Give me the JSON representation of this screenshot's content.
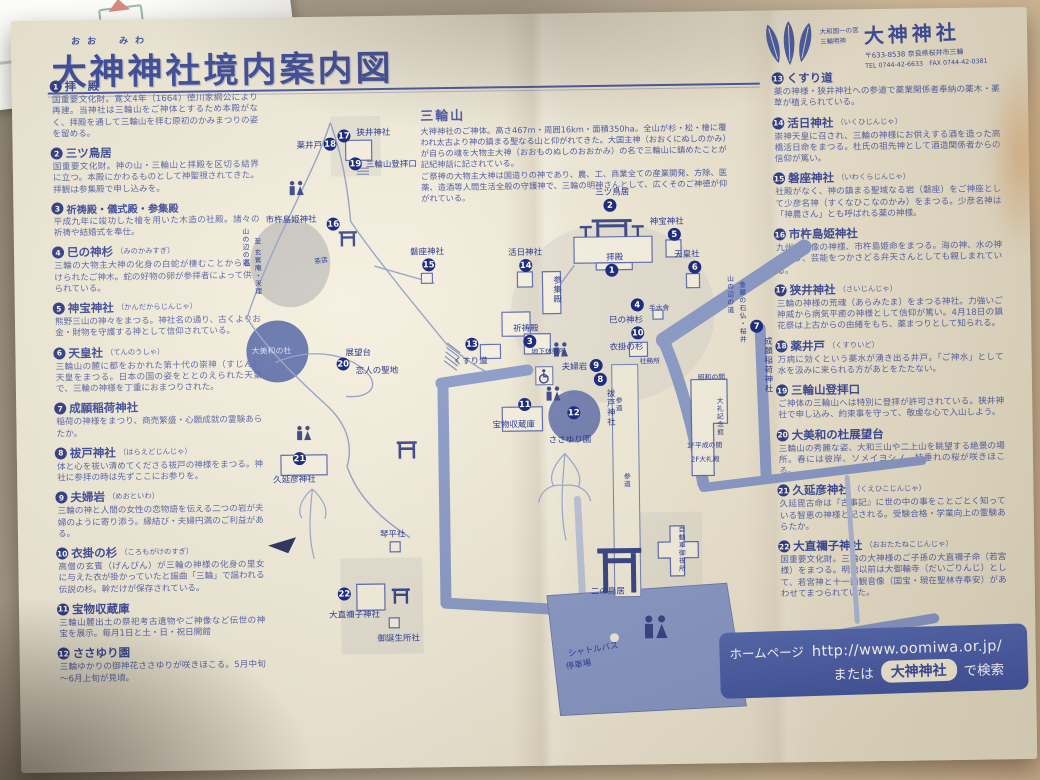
{
  "header": {
    "furigana": "おお　みわ",
    "title": "大神神社境内案内図"
  },
  "brand": {
    "line1": "大和国一の宮",
    "line2": "三輪明神",
    "name": "大神神社",
    "address": "〒633-8538 奈良県桜井市三輪",
    "tel": "TEL 0744-42-6633　FAX 0744-42-0381"
  },
  "mountain_note": {
    "title": "三輪山",
    "body": "大神神社のご神体。高さ467m・周囲16km・面積350ha。全山が杉・松・檜に覆われ太古より神の鎮まる聖なる山と仰がれてきた。大国主神（おおくにぬしのかみ）が自らの魂を大物主大神（おおものぬしのおおかみ）の名で三輪山に鎮めたことが記紀神話に記されている。\nご祭神の大物主大神は国造りの神であり、農、工、商業全ての産業開発、方除、医薬、造酒等人間生活全般の守護神で、三輪の明神さんとして、広くそのご神徳が仰がれている。"
  },
  "legend_left": [
    {
      "num": "1",
      "title": "拝　殿",
      "kana": "",
      "desc": "国重要文化財。寛文4年（1664）徳川家綱公により再建。当神社は三輪山をご神体とするため本殿がなく、拝殿を通して三輪山を拝む原初のかみまつりの姿を留める。"
    },
    {
      "num": "2",
      "title": "三ツ鳥居",
      "kana": "",
      "desc": "国重要文化財。神の山・三輪山と拝殿を区切る結界に立つ。本殿にかわるものとして神聖視されてきた。拝観は参集殿で申し込みを。"
    },
    {
      "num": "3",
      "title": "祈祷殿・儀式殿・参集殿",
      "kana": "",
      "desc": "平成九年に竣功した檜を用いた木造の社殿。諸々の祈祷や結婚式を奉仕。"
    },
    {
      "num": "4",
      "title": "巳の神杉",
      "kana": "（みのかみすぎ）",
      "desc": "三輪の大物主大神の化身の白蛇が棲むことから名付けられたご神木。蛇の好物の卵が参拝者によって供えられている。"
    },
    {
      "num": "5",
      "title": "神宝神社",
      "kana": "（かんだからじんじゃ）",
      "desc": "熊野三山の神々をまつる。神社名の通り、古くよりお金・財物を守護する神として信仰されている。"
    },
    {
      "num": "6",
      "title": "天皇社",
      "kana": "（てんのうしゃ）",
      "desc": "三輪山の麓に都をおかれた第十代の崇神（すじん）天皇をまつる。日本の国の姿をととのえられた天皇で、三輪の神様を丁重におまつりされた。"
    },
    {
      "num": "7",
      "title": "成願稲荷神社",
      "kana": "（じょうがんいなりじんじゃ）",
      "desc": "稲荷の神様をまつり、商売繁盛・心願成就の霊験あらたか。"
    },
    {
      "num": "8",
      "title": "祓戸神社",
      "kana": "（はらえどじんじゃ）",
      "desc": "体と心を祓い清めてくださる祓戸の神様をまつる。神社に参拝の時は先ずここにお参りを。"
    },
    {
      "num": "9",
      "title": "夫婦岩",
      "kana": "（めおといわ）",
      "desc": "三輪の神と人間の女性の恋物語を伝える二つの岩が夫婦のように寄り添う。縁結び・夫婦円満のご利益がある。"
    },
    {
      "num": "10",
      "title": "衣掛の杉",
      "kana": "（ころもがけのすぎ）",
      "desc": "高僧の玄賓（げんぴん）が三輪の神様の化身の里女に与えた衣が掛かっていたと謡曲「三輪」で謡われる伝説の杉。幹だけが保存されている。"
    },
    {
      "num": "11",
      "title": "宝物収蔵庫",
      "kana": "",
      "desc": "三輪山麓出土の祭祀考古遺物やご神像など伝世の神宝を展示。毎月1日と土・日・祝日開館"
    },
    {
      "num": "12",
      "title": "ささゆり園",
      "kana": "",
      "desc": "三輪ゆかりの御神花ささゆりが咲きほこる。5月中旬～6月上旬が見頃。"
    }
  ],
  "legend_right": [
    {
      "num": "13",
      "title": "くすり道",
      "kana": "",
      "desc": "薬の神様・狭井神社への参道で薬業関係者奉納の薬木・薬草が植えられている。"
    },
    {
      "num": "14",
      "title": "活日神社",
      "kana": "（いくひじんじゃ）",
      "desc": "崇神天皇に召され、三輪の神様にお供えする酒を造った高橋活日命をまつる。杜氏の祖先神として酒造関係者からの信仰が篤い。"
    },
    {
      "num": "15",
      "title": "磐座神社",
      "kana": "（いわくらじんじゃ）",
      "desc": "社殿がなく、神の鎮まる聖域なる岩（磐座）をご神座として少彦名神（すくなひこなのかみ）をまつる。少彦名神は「神農さん」とも呼ばれる薬の神様。"
    },
    {
      "num": "16",
      "title": "市杵島姫神社",
      "kana": "（いちきしまひめじんじゃ）",
      "desc": "九州の宗像の神様、市杵島姫命をまつる。海の神、水の神であり、芸能をつかさどる弁天さんとしても親しまれている。"
    },
    {
      "num": "17",
      "title": "狭井神社",
      "kana": "（さいじんじゃ）",
      "desc": "三輪の神様の荒魂（あらみたま）をまつる神社。力強いご神威から病気平癒の神様として信仰が篤い。4月18日の鎮花祭は上古からの由緒をもち、薬まつりとして知られる。"
    },
    {
      "num": "18",
      "title": "薬井戸",
      "kana": "（くすりいど）",
      "desc": "万病に効くという薬水が湧き出る井戸。「ご神水」として水を汲みに来られる方があとをたたない。"
    },
    {
      "num": "19",
      "title": "三輪山登拝口",
      "kana": "",
      "desc": "ご神体の三輪山へは特別に登拝が許可されている。狭井神社で申し込み、約束事を守って、敬虔な心で入山しよう。"
    },
    {
      "num": "20",
      "title": "大美和の杜展望台",
      "kana": "",
      "desc": "三輪山の秀麗な姿、大和三山や二上山を眺望する絶景の場所。春には彼岸、ソメイヨシノ、枝垂れの桜が咲きほこる。"
    },
    {
      "num": "21",
      "title": "久延彦神社",
      "kana": "（くえひこじんじゃ）",
      "desc": "久延毘古命は『古事記』に世の中の事をことごとく知っている智恵の神様と記される。受験合格・学業向上の霊験あらたか。"
    },
    {
      "num": "22",
      "title": "大直禰子神社",
      "kana": "（おおたたねこじんじゃ）",
      "desc": "国重要文化財。三輪の大神様のご子孫の大直禰子命（若宮様）をまつる。明治以前は大御輪寺（だいごりんじ）として、若宮神と十一面観音像（国宝・現在聖林寺奉安）があわせてまつられていた。"
    }
  ],
  "map": {
    "markers": [
      {
        "num": "1",
        "label": "拝殿"
      },
      {
        "num": "2",
        "label": "三ツ鳥居"
      },
      {
        "num": "3",
        "label": "祈祷殿"
      },
      {
        "num": "4",
        "label": "巳の神杉"
      },
      {
        "num": "5",
        "label": "神宝神社"
      },
      {
        "num": "6",
        "label": "天皇社"
      },
      {
        "num": "7",
        "label": "成願稲荷神社"
      },
      {
        "num": "8",
        "label": "祓戸神社"
      },
      {
        "num": "9",
        "label": "夫婦岩"
      },
      {
        "num": "10",
        "label": "衣掛の杉"
      },
      {
        "num": "11",
        "label": "宝物収蔵庫"
      },
      {
        "num": "12",
        "label": "ささゆり園"
      },
      {
        "num": "13",
        "label": "くすり道"
      },
      {
        "num": "14",
        "label": "活日神社"
      },
      {
        "num": "15",
        "label": "磐座神社"
      },
      {
        "num": "16",
        "label": "市杵島姫神社"
      },
      {
        "num": "17",
        "label": "狭井神社"
      },
      {
        "num": "18",
        "label": "薬井戸"
      },
      {
        "num": "19",
        "label": "三輪山登拝口"
      },
      {
        "num": "20",
        "label": "展望台"
      },
      {
        "num": "21",
        "label": "久延彦神社"
      },
      {
        "num": "22",
        "label": "大直禰子神社"
      }
    ],
    "labels": [
      {
        "text": "参集殿"
      },
      {
        "text": "手水舎"
      },
      {
        "text": "社務所"
      },
      {
        "text": "地下休憩所"
      },
      {
        "text": "昭和の間"
      },
      {
        "text": "大礼記念館"
      },
      {
        "text": "1F平成の間"
      },
      {
        "text": "2F大礼殿"
      },
      {
        "text": "琴平社"
      },
      {
        "text": "御誕生所社"
      },
      {
        "text": "二の鳥居"
      },
      {
        "text": "自動車御祓所"
      },
      {
        "text": "シャトルバス"
      },
      {
        "text": "停車場"
      },
      {
        "text": "茶店"
      },
      {
        "text": "大美和の杜"
      },
      {
        "text": "参道"
      },
      {
        "text": "参道"
      },
      {
        "text": "山の辺の道"
      },
      {
        "text": "金屋の石仏・桜井"
      },
      {
        "text": "山の辺の道"
      },
      {
        "text": "至 玄賓庵・天理"
      },
      {
        "text": "恋人の聖地"
      }
    ]
  },
  "footer": {
    "homepage_label": "ホームページ",
    "url": "http://www.oomiwa.or.jp/",
    "or_label": "または",
    "search_term": "大神神社",
    "search_suffix": "で検索"
  },
  "colors": {
    "print_navy": "#2e3e94",
    "road_slate": "#8193c6",
    "banner_blue": "#3f55a6",
    "paper_cream": "#f2ecd9",
    "badge_navy": "#1e2d7d"
  }
}
